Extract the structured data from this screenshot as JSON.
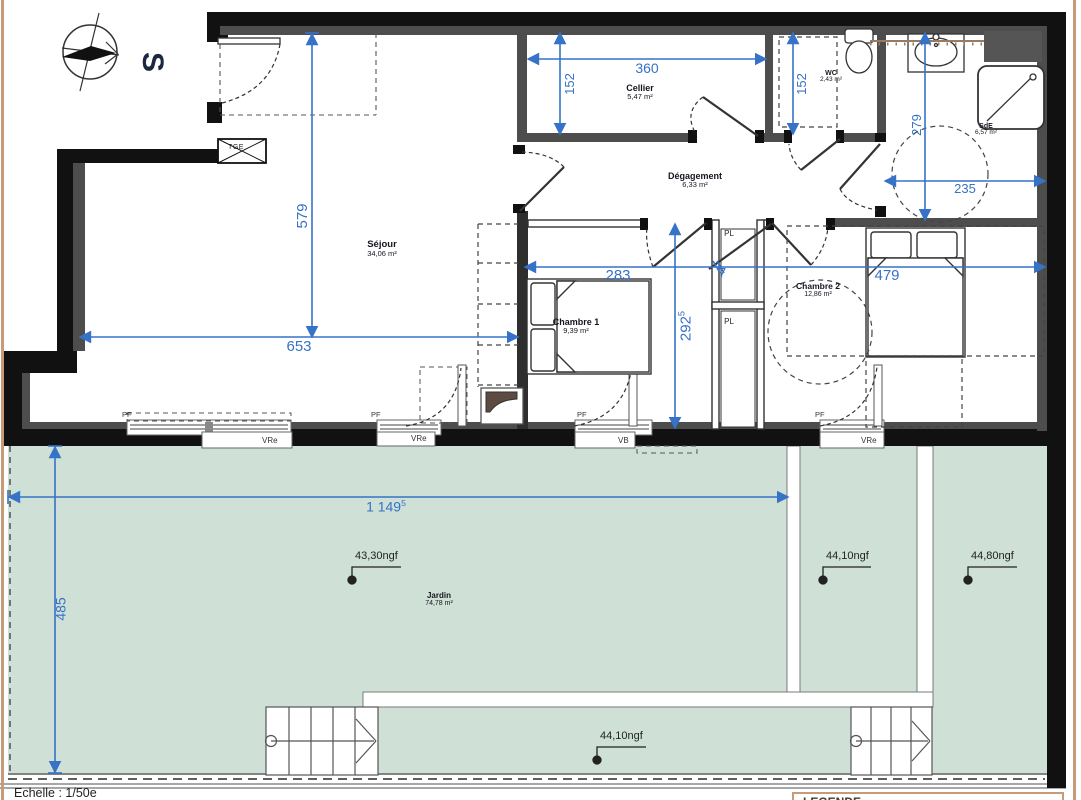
{
  "compass": {
    "letter": "S"
  },
  "scale": {
    "label": "Echelle : 1/50e"
  },
  "legend": {
    "title": "LEGENDE"
  },
  "rooms": {
    "sejour": {
      "name": "Séjour",
      "area": "34,06 m²"
    },
    "cellier": {
      "name": "Cellier",
      "area": "5,47 m²"
    },
    "degagement": {
      "name": "Dégagement",
      "area": "6,33 m²"
    },
    "wc": {
      "name": "WC",
      "area": "2,43 m²"
    },
    "sde": {
      "name": "SdE",
      "area": "6,57 m²"
    },
    "chambre1": {
      "name": "Chambre 1",
      "area": "9,39 m²"
    },
    "chambre2": {
      "name": "Chambre 2",
      "area": "12,86 m²"
    },
    "jardin": {
      "name": "Jardin",
      "area": "74,78 m²"
    }
  },
  "closets": {
    "pl1": "PL",
    "pl2": "PL"
  },
  "technical": {
    "tge": "TGE"
  },
  "windows": [
    {
      "top": "PF",
      "bottom": "VRe"
    },
    {
      "top": "PF",
      "bottom": "VRe"
    },
    {
      "top": "PF",
      "bottom": "VB"
    },
    {
      "top": "PF",
      "bottom": "VRe"
    }
  ],
  "dimensions": {
    "d579": "579",
    "d653": "653",
    "d360": "360",
    "d152_cellier": "152",
    "d152_wc": "152",
    "d279": "279",
    "d235": "235",
    "d283": "283",
    "d292": {
      "main": "292",
      "sup": "5"
    },
    "d7": "7",
    "d479": "479",
    "d1149": {
      "main": "1 149",
      "sup": "5"
    },
    "d485": "485"
  },
  "elevations": {
    "garden_left": "43,30ngf",
    "garden_mid": "44,10ngf",
    "garden_right": "44,80ngf",
    "garden_bottom": "44,10ngf"
  },
  "colors": {
    "dimension_blue": "#3672c8",
    "garden_green": "#cfe1d6",
    "wall_black": "#111111",
    "wall_gray": "#4d4d4d",
    "sheet_border": "#c79b79",
    "tile_brown": "#9b7a60"
  }
}
